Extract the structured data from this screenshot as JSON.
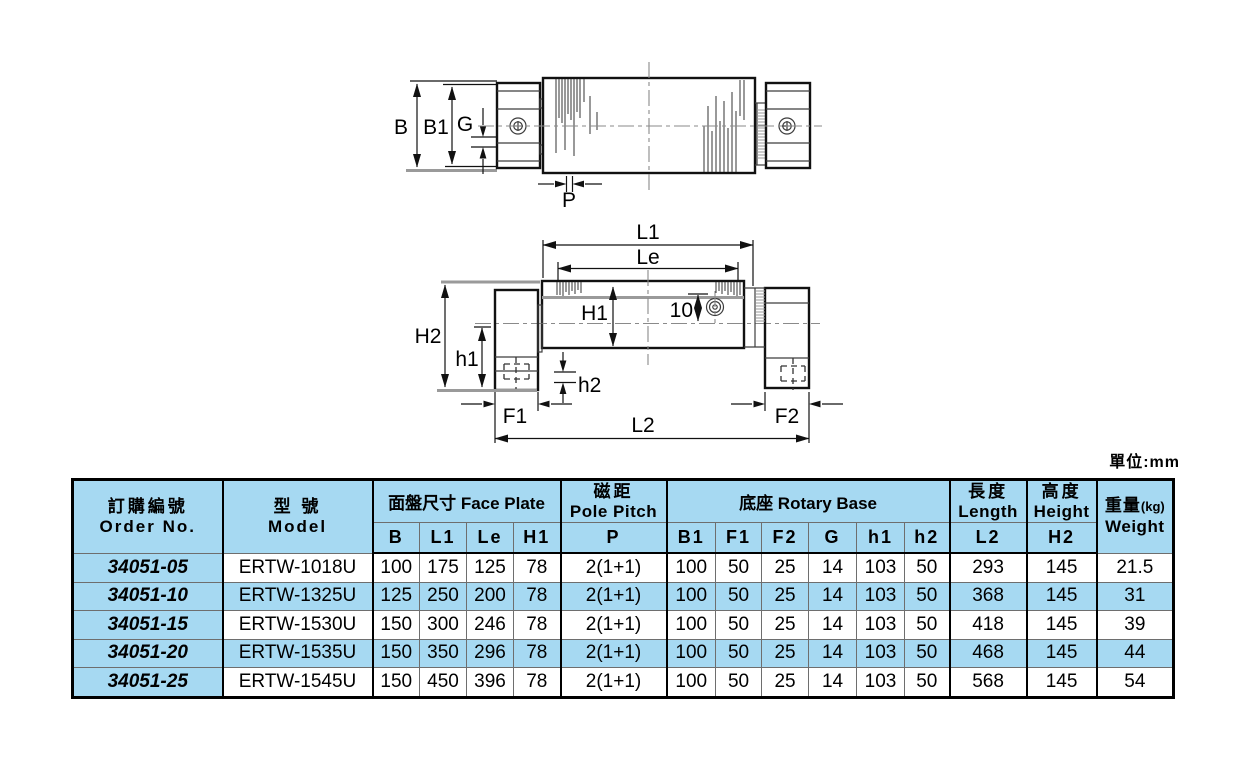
{
  "page": {
    "unit_label": "單位:mm"
  },
  "drawing": {
    "side_view": {
      "labels": {
        "B": "B",
        "B1": "B1",
        "G": "G",
        "P": "P"
      }
    },
    "front_view": {
      "labels": {
        "L1": "L1",
        "Le": "Le",
        "H1": "H1",
        "dim10": "10",
        "H2": "H2",
        "h1": "h1",
        "h2": "h2",
        "F1": "F1",
        "F2": "F2",
        "L2": "L2"
      }
    }
  },
  "table": {
    "header": {
      "order_no": {
        "zh": "訂購編號",
        "en": "Order No."
      },
      "model": {
        "zh": "型 號",
        "en": "Model"
      },
      "face_plate": "面盤尺寸 Face Plate",
      "pole_pitch": {
        "zh": "磁距",
        "en": "Pole Pitch"
      },
      "rotary_base": "底座 Rotary Base",
      "length": {
        "zh": "長度",
        "en": "Length"
      },
      "height": {
        "zh": "高度",
        "en": "Height"
      },
      "weight": {
        "zh": "重量",
        "unit": "(kg)",
        "en": "Weight"
      },
      "sub": [
        "B",
        "L1",
        "Le",
        "H1",
        "P",
        "B1",
        "F1",
        "F2",
        "G",
        "h1",
        "h2",
        "L2",
        "H2"
      ]
    },
    "rows": [
      {
        "order_no": "34051-05",
        "model": "ERTW-1018U",
        "values": [
          "100",
          "175",
          "125",
          "78",
          "2(1+1)",
          "100",
          "50",
          "25",
          "14",
          "103",
          "50",
          "293",
          "145",
          "21.5"
        ],
        "highlight": false
      },
      {
        "order_no": "34051-10",
        "model": "ERTW-1325U",
        "values": [
          "125",
          "250",
          "200",
          "78",
          "2(1+1)",
          "100",
          "50",
          "25",
          "14",
          "103",
          "50",
          "368",
          "145",
          "31"
        ],
        "highlight": true
      },
      {
        "order_no": "34051-15",
        "model": "ERTW-1530U",
        "values": [
          "150",
          "300",
          "246",
          "78",
          "2(1+1)",
          "100",
          "50",
          "25",
          "14",
          "103",
          "50",
          "418",
          "145",
          "39"
        ],
        "highlight": false
      },
      {
        "order_no": "34051-20",
        "model": "ERTW-1535U",
        "values": [
          "150",
          "350",
          "296",
          "78",
          "2(1+1)",
          "100",
          "50",
          "25",
          "14",
          "103",
          "50",
          "468",
          "145",
          "44"
        ],
        "highlight": true
      },
      {
        "order_no": "34051-25",
        "model": "ERTW-1545U",
        "values": [
          "150",
          "450",
          "396",
          "78",
          "2(1+1)",
          "100",
          "50",
          "25",
          "14",
          "103",
          "50",
          "568",
          "145",
          "54"
        ],
        "highlight": false
      }
    ]
  },
  "colors": {
    "highlight_blue": "#a6d9f2",
    "line_black": "#111111",
    "line_gray": "#9a9a9a"
  }
}
